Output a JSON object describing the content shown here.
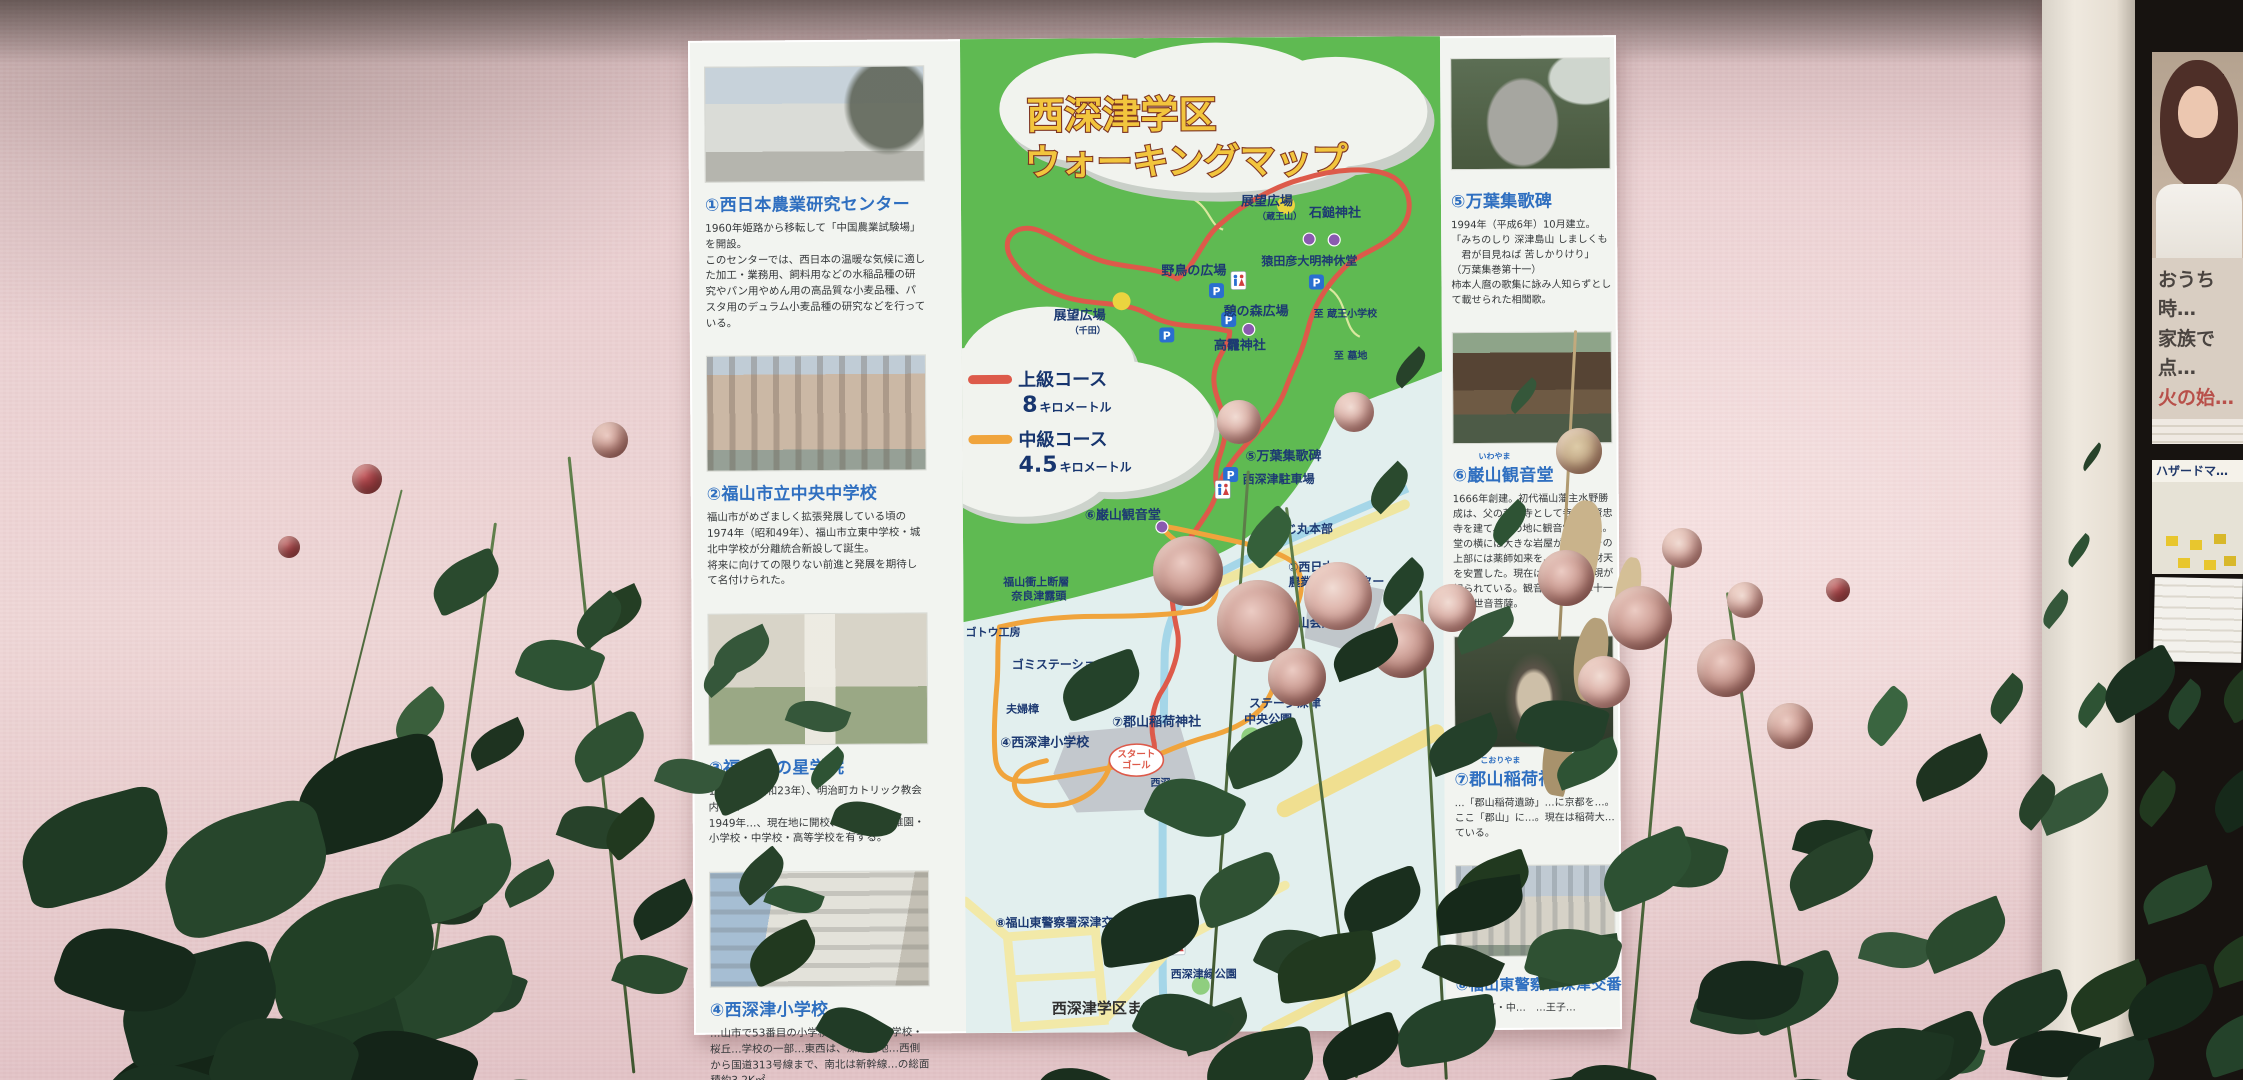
{
  "sign": {
    "title": {
      "line1": "西深津学区",
      "line2": "ウォーキングマップ"
    },
    "legend": {
      "advanced_label": "上級コース",
      "advanced_distance": "8",
      "advanced_unit": "キロメートル",
      "advanced_color": "#dd5a4a",
      "intermediate_label": "中級コース",
      "intermediate_distance": "4.5",
      "intermediate_unit": "キロメートル",
      "intermediate_color": "#f0a43c"
    },
    "footer": "西深津学区まちづくり…",
    "left_items": [
      {
        "number": "①",
        "name": "西日本農業研究センター",
        "desc": "1960年姫路から移転して「中国農業試験場」を開設。\nこのセンターでは、西日本の温暖な気候に適した加工・業務用、飼料用などの水稲品種の研究やパン用やめん用の高品質な小麦品種、パスタ用のデュラム小麦品種の研究などを行っている。"
      },
      {
        "number": "②",
        "name": "福山市立中央中学校",
        "desc": "福山市がめざましく拡張発展している頃の1974年（昭和49年）、福山市立東中学校・城北中学校が分離統合新設して誕生。\n将来に向けての限りない前進と発展を期待して名付けられた。"
      },
      {
        "number": "③",
        "name": "福山暁の星学院",
        "desc": "1948年（昭和23年）、明治町カトリック教会内に…\n1949年…、現在地に開校、保育園・幼稚園・小学校・中学校・高等学校を有する。"
      },
      {
        "number": "④",
        "name": "西深津小学校",
        "desc": "…山市で53番目の小学校…学校・東小学校・桜丘…学校の一部…東西は、深津高地…西側から国道313号線まで、南北は新幹線…の総面積約3.2K㎡。"
      }
    ],
    "right_items": [
      {
        "number": "⑤",
        "name": "万葉集歌碑",
        "furigana": "",
        "desc": "1994年（平成6年）10月建立。\n「みちのしり 深津島山 しましくも\n　君が目見ねば 苦しかりけり」\n（万葉集巻第十一）\n柿本人麿の歌集に詠み人知らずとして載せられた相聞歌。"
      },
      {
        "number": "⑥",
        "name": "巌山観音堂",
        "furigana": "いわやま",
        "desc": "1666年創建。初代福山藩主水野勝成は、父の菩提寺として寺町に賢忠寺を建て、この地に観音堂を建立。堂の横には大きな岩屋があり、その上部には薬師如来を、下には弁財天を安置した。現在は、石鎚大権現が祀られている。観音堂の本尊は十一面観世音菩薩。"
      },
      {
        "number": "⑦",
        "name": "郡山稲荷神社",
        "furigana": "こおりやま",
        "desc": "…「郡山稲荷遺跡」…に京都を…。ここ「郡山」に…。現在は稲荷大…ている。"
      },
      {
        "number": "⑧",
        "name": "福山東警察署深津交番",
        "furigana": "",
        "desc": "西深津町・中…　…王子…"
      }
    ],
    "map": {
      "parking_letter": "P",
      "start_goal_line1": "スタート",
      "start_goal_line2": "ゴール",
      "labels": [
        "展望広場",
        "（蔵王山）",
        "石鎚神社",
        "猿田彦大明神休堂",
        "野鳥の広場",
        "憩の森広場",
        "至 蔵王小学校",
        "高龗神社",
        "至 墓地",
        "展望広場",
        "（千田）",
        "⑤万葉集歌碑",
        "西深津駐車場",
        "すじ丸本部",
        "①西日本",
        "農業研究センター",
        "⑥巌山観音堂",
        "福山衝上断層",
        "奈良津露頭",
        "ゴトウ工房",
        "ゴミステーション",
        "夫婦樟",
        "④西深津小学校",
        "⑦郡山稲荷神社",
        "西深…",
        "巌山公園",
        "巌山会館",
        "ステージ深津",
        "中央公園",
        "⑧福山東警察署深津交番",
        "東橋",
        "西深津緑公園"
      ]
    }
  },
  "right_board": {
    "poster_line1": "おうち時…",
    "poster_line2": "家族で点…",
    "poster_line3": "火の始…",
    "hazard_label": "ハザードマ…"
  }
}
